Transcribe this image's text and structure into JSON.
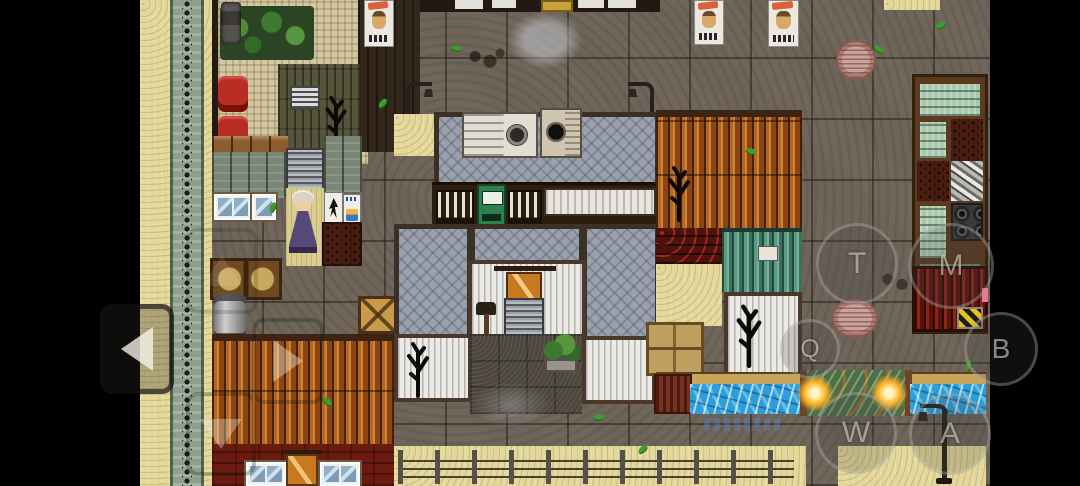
{
  "app": {
    "kind": "mobile-rpg-touch-screen",
    "orientation": "landscape"
  },
  "touch_controls": {
    "buttons": [
      {
        "id": "btn-t",
        "label": "T"
      },
      {
        "id": "btn-m",
        "label": "M"
      },
      {
        "id": "btn-q",
        "label": "Q"
      },
      {
        "id": "btn-b",
        "label": "B"
      },
      {
        "id": "btn-w",
        "label": "W"
      },
      {
        "id": "btn-a",
        "label": "A"
      }
    ],
    "dpad": [
      {
        "id": "dpad-up",
        "direction": "up",
        "icon": "up-arrow-icon"
      },
      {
        "id": "dpad-left",
        "direction": "left",
        "icon": "left-arrow-icon"
      },
      {
        "id": "dpad-right",
        "direction": "right",
        "icon": "right-arrow-icon"
      },
      {
        "id": "dpad-down",
        "direction": "down",
        "icon": "down-arrow-icon"
      }
    ]
  },
  "palette": {
    "letterbox": "#000000",
    "stone_ground": "#6e6459",
    "sand_path": "#e3d89a",
    "water": "#2d9ed8",
    "roof_orange": "#a3571b",
    "roof_teal": "#4d8674",
    "wall_red": "#6b1a10",
    "pavement_gray": "#9aa1ae",
    "mosaic_floor": "#d3c8a2",
    "glow_lamp": "#ffb428"
  },
  "scene": {
    "npcs": [
      {
        "id": "elderly-woman",
        "location": "shop-interior"
      }
    ],
    "landmarks": [
      "shop-interior",
      "courtyard-house",
      "canal-bridge",
      "storage-shelves",
      "fenced-sand-path"
    ]
  }
}
